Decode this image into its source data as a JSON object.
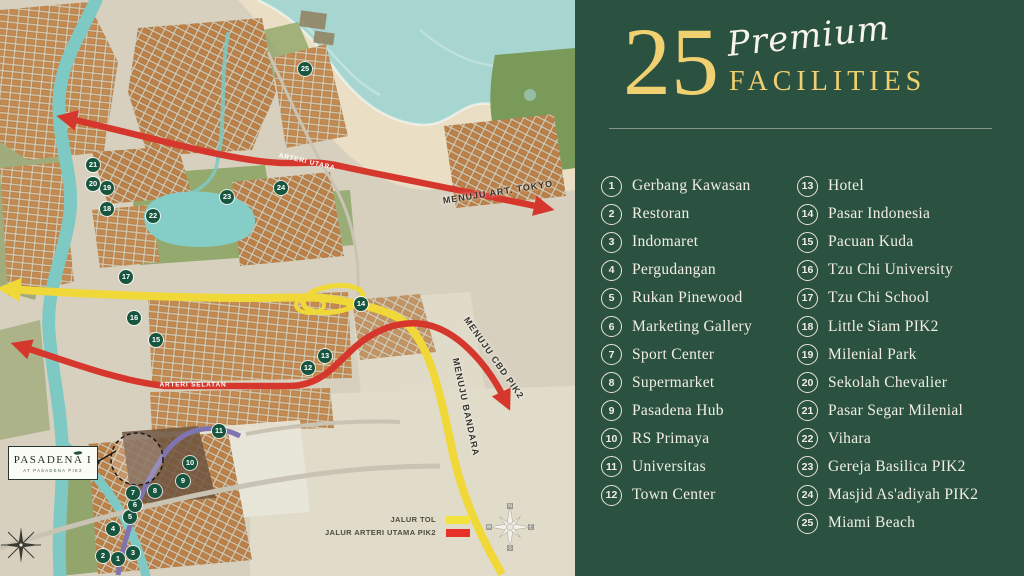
{
  "panel": {
    "count": "25",
    "title_script": "Premium",
    "title_caps": "FACILITIES",
    "facilities_left": [
      {
        "num": "1",
        "label": "Gerbang Kawasan"
      },
      {
        "num": "2",
        "label": "Restoran"
      },
      {
        "num": "3",
        "label": "Indomaret"
      },
      {
        "num": "4",
        "label": "Pergudangan"
      },
      {
        "num": "5",
        "label": "Rukan Pinewood"
      },
      {
        "num": "6",
        "label": "Marketing Gallery"
      },
      {
        "num": "7",
        "label": "Sport Center"
      },
      {
        "num": "8",
        "label": "Supermarket"
      },
      {
        "num": "9",
        "label": "Pasadena Hub"
      },
      {
        "num": "10",
        "label": "RS Primaya"
      },
      {
        "num": "11",
        "label": "Universitas"
      },
      {
        "num": "12",
        "label": "Town Center"
      }
    ],
    "facilities_right": [
      {
        "num": "13",
        "label": "Hotel"
      },
      {
        "num": "14",
        "label": "Pasar Indonesia"
      },
      {
        "num": "15",
        "label": "Pacuan Kuda"
      },
      {
        "num": "16",
        "label": "Tzu Chi University"
      },
      {
        "num": "17",
        "label": "Tzu Chi School"
      },
      {
        "num": "18",
        "label": "Little Siam PIK2"
      },
      {
        "num": "19",
        "label": "Milenial Park"
      },
      {
        "num": "20",
        "label": "Sekolah Chevalier"
      },
      {
        "num": "21",
        "label": "Pasar Segar Milenial"
      },
      {
        "num": "22",
        "label": "Vihara"
      },
      {
        "num": "23",
        "label": "Gereja Basilica PIK2"
      },
      {
        "num": "24",
        "label": "Masjid As'adiyah PIK2"
      },
      {
        "num": "25",
        "label": "Miami Beach"
      }
    ]
  },
  "map": {
    "project_label": {
      "title": "PASADENA I",
      "subtitle": "AT PASADENA PIK2"
    },
    "road_labels": {
      "menuju_art_tokyo": "MENUJU ART. TOKYO",
      "arteri_utara": "ARTERI UTARA",
      "arteri_selatan": "ARTERI SELATAN",
      "menuju_cbd_pik2": "MENUJU CBD PIK2",
      "menuju_bandara": "MENUJU BANDARA"
    },
    "legend": [
      {
        "label": "JALUR TOL",
        "color": "#f2e43c"
      },
      {
        "label": "JALUR ARTERI UTAMA PIK2",
        "color": "#e63028"
      }
    ],
    "compass_letters": {
      "n": "N",
      "e": "E",
      "s": "S",
      "w": "W"
    },
    "markers": [
      {
        "num": "1",
        "x": 118,
        "y": 559
      },
      {
        "num": "2",
        "x": 103,
        "y": 556
      },
      {
        "num": "3",
        "x": 133,
        "y": 553
      },
      {
        "num": "4",
        "x": 113,
        "y": 529
      },
      {
        "num": "5",
        "x": 130,
        "y": 517
      },
      {
        "num": "6",
        "x": 135,
        "y": 505
      },
      {
        "num": "7",
        "x": 133,
        "y": 493
      },
      {
        "num": "8",
        "x": 155,
        "y": 491
      },
      {
        "num": "9",
        "x": 183,
        "y": 481
      },
      {
        "num": "10",
        "x": 190,
        "y": 463
      },
      {
        "num": "11",
        "x": 219,
        "y": 431
      },
      {
        "num": "12",
        "x": 308,
        "y": 368
      },
      {
        "num": "13",
        "x": 325,
        "y": 356
      },
      {
        "num": "14",
        "x": 361,
        "y": 304
      },
      {
        "num": "15",
        "x": 156,
        "y": 340
      },
      {
        "num": "16",
        "x": 134,
        "y": 318
      },
      {
        "num": "17",
        "x": 126,
        "y": 277
      },
      {
        "num": "18",
        "x": 107,
        "y": 209
      },
      {
        "num": "19",
        "x": 107,
        "y": 188
      },
      {
        "num": "20",
        "x": 93,
        "y": 184
      },
      {
        "num": "21",
        "x": 93,
        "y": 165
      },
      {
        "num": "22",
        "x": 153,
        "y": 216
      },
      {
        "num": "23",
        "x": 227,
        "y": 197
      },
      {
        "num": "24",
        "x": 281,
        "y": 188
      },
      {
        "num": "25",
        "x": 305,
        "y": 69
      }
    ]
  },
  "colors": {
    "panel_bg": "#2b5240",
    "gold": "#f0d070",
    "marker_green": "#17553f",
    "toll_yellow": "#f2e43c",
    "artery_red": "#d6372c"
  }
}
